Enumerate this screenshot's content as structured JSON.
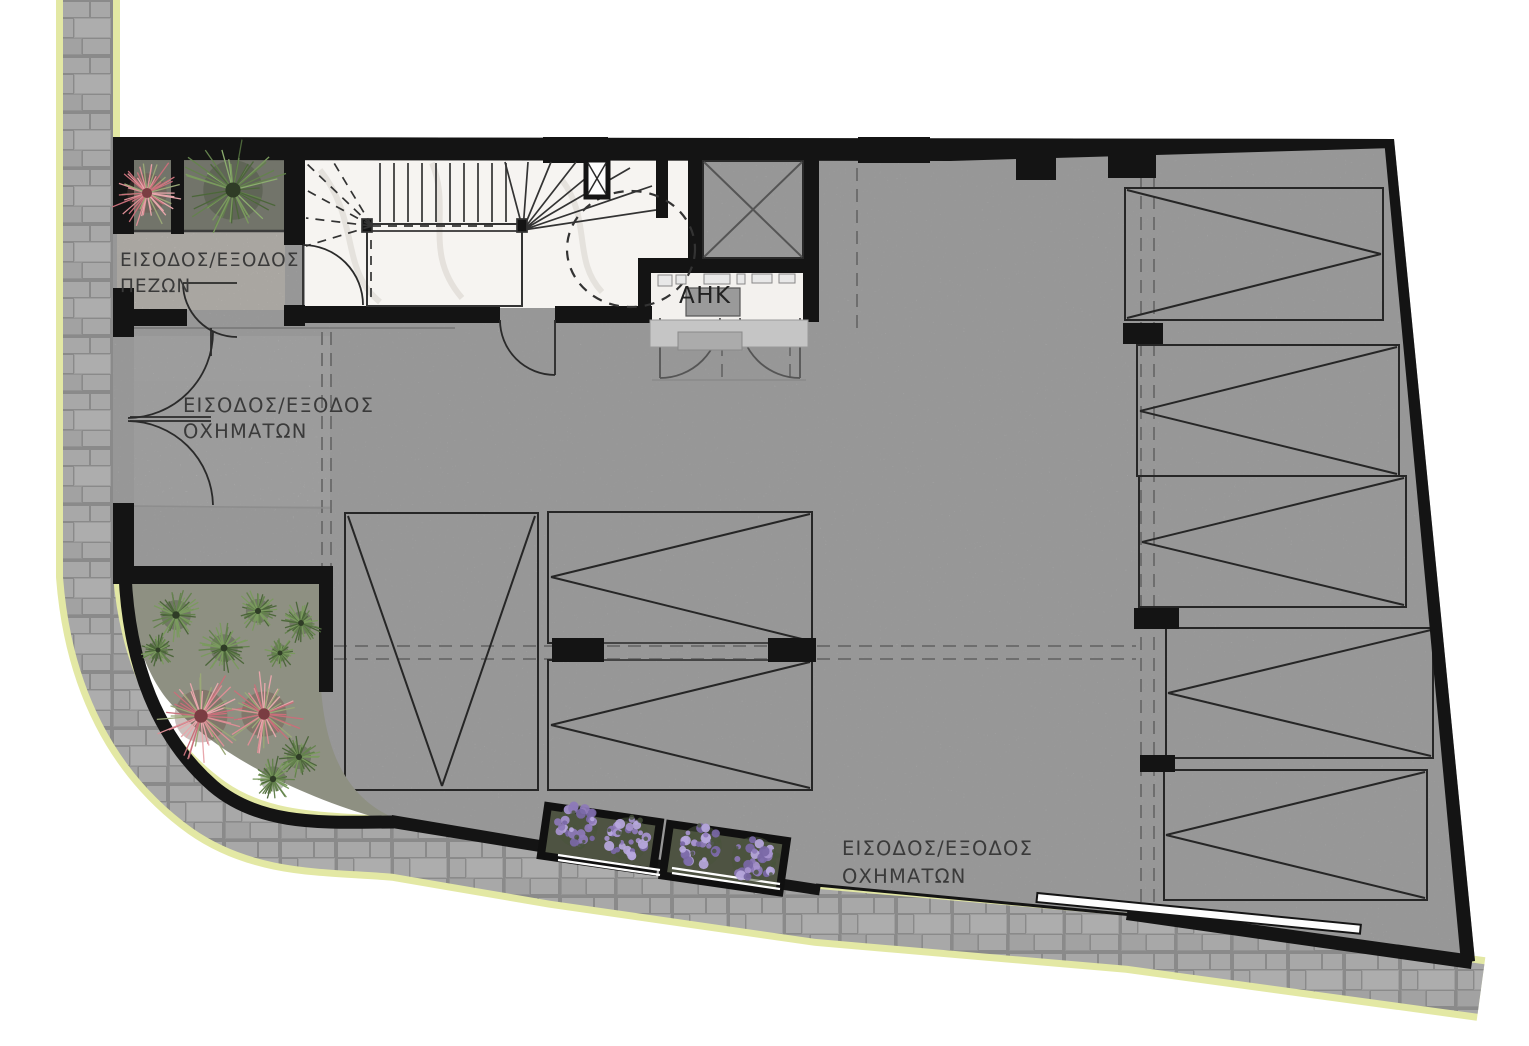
{
  "labels": {
    "pedestrian_entrance": {
      "line1": "ΕΙΣΟΔΟΣ/ΕΞΟΔΟΣ",
      "line2": "ΠΕΖΩΝ"
    },
    "vehicle_entrance_side": {
      "line1": "ΕΙΣΟΔΟΣ/ΕΞΟΔΟΣ",
      "line2": "ΟΧΗΜΑΤΩΝ"
    },
    "vehicle_entrance_bottom": {
      "line1": "ΕΙΣΟΔΟΣ/ΕΞΟΔΟΣ",
      "line2": "ΟΧΗΜΑΤΩΝ"
    },
    "utility_room": "AHK"
  },
  "counts": {
    "parking_spaces": 8,
    "planters": 5
  },
  "colors": {
    "wall": "#141414",
    "concrete_floor": "#b9b9b9",
    "ramp_floor": "#c9c9c9",
    "entrance_stone": "#d9d5cf",
    "marble_floor": "#f6f4f1",
    "paving_base": "#a8a8a8",
    "paving_joint": "#8a8a8a",
    "curb_edge": "#e3e8a4",
    "planter_soil": "#72746a",
    "corner_planter_soil": "#8e9082",
    "planter_box": "#4e5342",
    "plant_green": "#64824d",
    "plant_pink": "#dd8f96",
    "plant_purple": "#a493cd",
    "line_dark": "#2a2a2a",
    "dash_gray": "#6e6e6e"
  }
}
